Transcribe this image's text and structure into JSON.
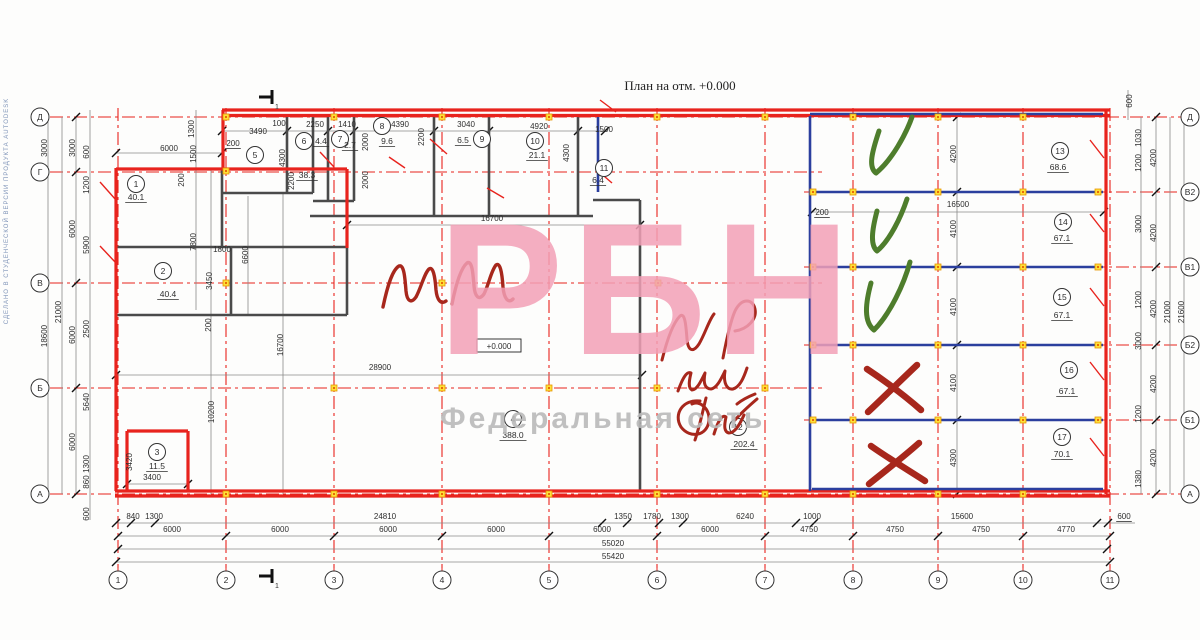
{
  "meta": {
    "title": "План на отм. +0.000",
    "elevation_label": "+0.000",
    "section_mark_label": "1",
    "side_watermark": "СДЕЛАНО В СТУДЕНЧЕСКОЙ ВЕРСИИ ПРОДУКТА AUTODESK"
  },
  "watermark": {
    "big": "РБН",
    "sub": "Федеральная сеть",
    "big_color": "#f2a0b6",
    "sub_color": "#bdbdbd"
  },
  "colors": {
    "wall_red": "#e8231d",
    "wall_blue": "#2b3f9e",
    "wall_grey": "#4a4a4a",
    "grid_red": "#e8231d",
    "dim_line": "#8a8a8a",
    "marker_yellow": "#ffe13a",
    "marker_orange": "#e69500",
    "hand_green": "#4e7d2c",
    "hand_red": "#a7271c"
  },
  "axes": {
    "bottom": [
      {
        "label": "1",
        "x": 118
      },
      {
        "label": "2",
        "x": 226
      },
      {
        "label": "3",
        "x": 334
      },
      {
        "label": "4",
        "x": 442
      },
      {
        "label": "5",
        "x": 549
      },
      {
        "label": "6",
        "x": 657
      },
      {
        "label": "7",
        "x": 765
      },
      {
        "label": "8",
        "x": 853
      },
      {
        "label": "9",
        "x": 938
      },
      {
        "label": "10",
        "x": 1023
      },
      {
        "label": "11",
        "x": 1110
      }
    ],
    "left": [
      {
        "label": "Д",
        "y": 117
      },
      {
        "label": "Г",
        "y": 172
      },
      {
        "label": "В",
        "y": 283
      },
      {
        "label": "Б",
        "y": 388
      },
      {
        "label": "А",
        "y": 494
      }
    ],
    "right": [
      {
        "label": "Д",
        "y": 117
      },
      {
        "label": "В2",
        "y": 192
      },
      {
        "label": "В1",
        "y": 267
      },
      {
        "label": "Б2",
        "y": 345
      },
      {
        "label": "Б1",
        "y": 420
      },
      {
        "label": "А",
        "y": 494
      }
    ]
  },
  "rooms": [
    {
      "n": "1",
      "area": "40.1",
      "cx": 136,
      "cy": 184,
      "ax": 136,
      "ay": 200
    },
    {
      "n": "2",
      "area": "40.4",
      "cx": 163,
      "cy": 271,
      "ax": 168,
      "ay": 297
    },
    {
      "n": "3",
      "area": "11.5",
      "cx": 157,
      "cy": 452,
      "ax": 157,
      "ay": 469
    },
    {
      "n": "4",
      "area": "388.0",
      "cx": 513,
      "cy": 419,
      "ax": 513,
      "ay": 438
    },
    {
      "n": "5",
      "area": "38.3",
      "cx": 255,
      "cy": 155,
      "ax": 307,
      "ay": 178
    },
    {
      "n": "6",
      "area": "4.4",
      "cx": 304,
      "cy": 141,
      "ax": 321,
      "ay": 144
    },
    {
      "n": "7",
      "area": "2.7",
      "cx": 340,
      "cy": 139,
      "ax": 350,
      "ay": 148
    },
    {
      "n": "8",
      "area": "9.6",
      "cx": 382,
      "cy": 126,
      "ax": 387,
      "ay": 144
    },
    {
      "n": "9",
      "area": "6.5",
      "cx": 482,
      "cy": 139,
      "ax": 463,
      "ay": 143
    },
    {
      "n": "10",
      "area": "21.1",
      "cx": 535,
      "cy": 141,
      "ax": 537,
      "ay": 158
    },
    {
      "n": "11",
      "area": "6.4",
      "cx": 604,
      "cy": 168,
      "ax": 598,
      "ay": 183
    },
    {
      "n": "12",
      "area": "202.4",
      "cx": 738,
      "cy": 427,
      "ax": 744,
      "ay": 447
    },
    {
      "n": "13",
      "area": "68.6",
      "cx": 1060,
      "cy": 151,
      "ax": 1058,
      "ay": 170
    },
    {
      "n": "14",
      "area": "67.1",
      "cx": 1063,
      "cy": 222,
      "ax": 1062,
      "ay": 241
    },
    {
      "n": "15",
      "area": "67.1",
      "cx": 1062,
      "cy": 297,
      "ax": 1062,
      "ay": 318
    },
    {
      "n": "16",
      "area": "67.1",
      "cx": 1069,
      "cy": 370,
      "ax": 1067,
      "ay": 394
    },
    {
      "n": "17",
      "area": "70.1",
      "cx": 1062,
      "cy": 437,
      "ax": 1062,
      "ay": 457
    }
  ],
  "dims": [
    {
      "t": "3490",
      "x": 258,
      "y": 134
    },
    {
      "t": "100",
      "x": 279,
      "y": 126
    },
    {
      "t": "2250",
      "x": 315,
      "y": 127
    },
    {
      "t": "1410",
      "x": 347,
      "y": 127
    },
    {
      "t": "4390",
      "x": 400,
      "y": 127
    },
    {
      "t": "3040",
      "x": 466,
      "y": 127
    },
    {
      "t": "4920",
      "x": 539,
      "y": 129
    },
    {
      "t": "1500",
      "x": 604,
      "y": 132
    },
    {
      "t": "200",
      "x": 233,
      "y": 146,
      "f": "u"
    },
    {
      "t": "6000",
      "x": 169,
      "y": 151
    },
    {
      "t": "1300",
      "x": 194,
      "y": 129,
      "f": "r"
    },
    {
      "t": "1500",
      "x": 196,
      "y": 154,
      "f": "r"
    },
    {
      "t": "200",
      "x": 184,
      "y": 180,
      "f": "r"
    },
    {
      "t": "4300",
      "x": 285,
      "y": 158,
      "f": "r"
    },
    {
      "t": "2200",
      "x": 294,
      "y": 181,
      "f": "r"
    },
    {
      "t": "2000",
      "x": 368,
      "y": 142,
      "f": "r"
    },
    {
      "t": "2000",
      "x": 368,
      "y": 180,
      "f": "r"
    },
    {
      "t": "2200",
      "x": 424,
      "y": 137,
      "f": "r"
    },
    {
      "t": "4300",
      "x": 569,
      "y": 153,
      "f": "r"
    },
    {
      "t": "16700",
      "x": 492,
      "y": 221
    },
    {
      "t": "1800",
      "x": 222,
      "y": 252
    },
    {
      "t": "6600",
      "x": 248,
      "y": 255,
      "f": "r"
    },
    {
      "t": "7800",
      "x": 196,
      "y": 242,
      "f": "r"
    },
    {
      "t": "3450",
      "x": 212,
      "y": 281,
      "f": "r"
    },
    {
      "t": "200",
      "x": 211,
      "y": 325,
      "f": "r"
    },
    {
      "t": "16700",
      "x": 283,
      "y": 345,
      "f": "r"
    },
    {
      "t": "28900",
      "x": 380,
      "y": 370
    },
    {
      "t": "10200",
      "x": 214,
      "y": 412,
      "f": "r"
    },
    {
      "t": "3420",
      "x": 132,
      "y": 462,
      "f": "r"
    },
    {
      "t": "3400",
      "x": 152,
      "y": 480
    },
    {
      "t": "16500",
      "x": 958,
      "y": 207
    },
    {
      "t": "200",
      "x": 822,
      "y": 215,
      "f": "u"
    },
    {
      "t": "4200",
      "x": 956,
      "y": 154,
      "f": "r"
    },
    {
      "t": "4100",
      "x": 956,
      "y": 229,
      "f": "r"
    },
    {
      "t": "4100",
      "x": 956,
      "y": 307,
      "f": "r"
    },
    {
      "t": "4100",
      "x": 956,
      "y": 383,
      "f": "r"
    },
    {
      "t": "4300",
      "x": 956,
      "y": 458,
      "f": "r"
    },
    {
      "t": "3000",
      "x": 47,
      "y": 148,
      "f": "r"
    },
    {
      "t": "3000",
      "x": 75,
      "y": 148,
      "f": "r"
    },
    {
      "t": "600",
      "x": 89,
      "y": 152,
      "f": "r"
    },
    {
      "t": "1200",
      "x": 89,
      "y": 185,
      "f": "r"
    },
    {
      "t": "6000",
      "x": 75,
      "y": 229,
      "f": "r"
    },
    {
      "t": "5900",
      "x": 89,
      "y": 245,
      "f": "r"
    },
    {
      "t": "21000",
      "x": 61,
      "y": 312,
      "f": "r"
    },
    {
      "t": "18600",
      "x": 47,
      "y": 336,
      "f": "r"
    },
    {
      "t": "6000",
      "x": 75,
      "y": 335,
      "f": "r"
    },
    {
      "t": "2500",
      "x": 89,
      "y": 329,
      "f": "r"
    },
    {
      "t": "5640",
      "x": 89,
      "y": 402,
      "f": "r"
    },
    {
      "t": "6000",
      "x": 75,
      "y": 442,
      "f": "r"
    },
    {
      "t": "1300",
      "x": 89,
      "y": 464,
      "f": "r"
    },
    {
      "t": "860",
      "x": 89,
      "y": 482,
      "f": "r"
    },
    {
      "t": "600",
      "x": 89,
      "y": 514,
      "f": "r"
    },
    {
      "t": "600",
      "x": 1132,
      "y": 101,
      "f": "r"
    },
    {
      "t": "1030",
      "x": 1141,
      "y": 138,
      "f": "r"
    },
    {
      "t": "1200",
      "x": 1141,
      "y": 163,
      "f": "r"
    },
    {
      "t": "3000",
      "x": 1141,
      "y": 224,
      "f": "r"
    },
    {
      "t": "1200",
      "x": 1141,
      "y": 300,
      "f": "r"
    },
    {
      "t": "3000",
      "x": 1141,
      "y": 341,
      "f": "r"
    },
    {
      "t": "1200",
      "x": 1141,
      "y": 414,
      "f": "r"
    },
    {
      "t": "1380",
      "x": 1141,
      "y": 479,
      "f": "r"
    },
    {
      "t": "4200",
      "x": 1156,
      "y": 158,
      "f": "r"
    },
    {
      "t": "4200",
      "x": 1156,
      "y": 233,
      "f": "r"
    },
    {
      "t": "4200",
      "x": 1156,
      "y": 309,
      "f": "r"
    },
    {
      "t": "4200",
      "x": 1156,
      "y": 384,
      "f": "r"
    },
    {
      "t": "4200",
      "x": 1156,
      "y": 458,
      "f": "r"
    },
    {
      "t": "21000",
      "x": 1170,
      "y": 312,
      "f": "r"
    },
    {
      "t": "21600",
      "x": 1184,
      "y": 312,
      "f": "r"
    },
    {
      "t": "840",
      "x": 133,
      "y": 519
    },
    {
      "t": "1300",
      "x": 154,
      "y": 519
    },
    {
      "t": "24810",
      "x": 385,
      "y": 519
    },
    {
      "t": "1350",
      "x": 623,
      "y": 519
    },
    {
      "t": "1780",
      "x": 652,
      "y": 519
    },
    {
      "t": "1300",
      "x": 680,
      "y": 519
    },
    {
      "t": "6240",
      "x": 745,
      "y": 519
    },
    {
      "t": "1000",
      "x": 812,
      "y": 519
    },
    {
      "t": "15600",
      "x": 962,
      "y": 519
    },
    {
      "t": "600",
      "x": 1124,
      "y": 519,
      "f": "u"
    },
    {
      "t": "6000",
      "x": 172,
      "y": 532
    },
    {
      "t": "6000",
      "x": 280,
      "y": 532
    },
    {
      "t": "6000",
      "x": 388,
      "y": 532
    },
    {
      "t": "6000",
      "x": 496,
      "y": 532
    },
    {
      "t": "6000",
      "x": 602,
      "y": 532
    },
    {
      "t": "6000",
      "x": 710,
      "y": 532
    },
    {
      "t": "4750",
      "x": 809,
      "y": 532
    },
    {
      "t": "4750",
      "x": 895,
      "y": 532
    },
    {
      "t": "4750",
      "x": 981,
      "y": 532
    },
    {
      "t": "4770",
      "x": 1066,
      "y": 532
    },
    {
      "t": "55020",
      "x": 613,
      "y": 546
    },
    {
      "t": "55420",
      "x": 613,
      "y": 559
    }
  ],
  "walls": {
    "red": [
      [
        222,
        110,
        1110,
        110
      ],
      [
        222,
        115.5,
        1110,
        115.5
      ],
      [
        1106,
        110,
        1106,
        494
      ],
      [
        115,
        491,
        1110,
        491
      ],
      [
        115,
        496,
        1110,
        496
      ],
      [
        116,
        168,
        116,
        491
      ],
      [
        116,
        169,
        347,
        169
      ],
      [
        223,
        110,
        223,
        169
      ],
      [
        347,
        169,
        347,
        248
      ],
      [
        127,
        431,
        188,
        431
      ],
      [
        188,
        431,
        188,
        491
      ],
      [
        127,
        431,
        127,
        491
      ]
    ],
    "blue": [
      [
        810,
        114,
        1103,
        114
      ],
      [
        810,
        116,
        810,
        491
      ],
      [
        598,
        117,
        598,
        192
      ],
      [
        812,
        192,
        1103,
        192
      ],
      [
        812,
        267,
        1103,
        267
      ],
      [
        812,
        345,
        1103,
        345
      ],
      [
        812,
        420,
        1103,
        420
      ],
      [
        812,
        489,
        1103,
        489
      ]
    ],
    "grey": [
      [
        222,
        193,
        313,
        193
      ],
      [
        287,
        117,
        287,
        193
      ],
      [
        313,
        117,
        313,
        193
      ],
      [
        328,
        117,
        328,
        201
      ],
      [
        354,
        117,
        354,
        201
      ],
      [
        434,
        117,
        434,
        216
      ],
      [
        489,
        117,
        489,
        216
      ],
      [
        578,
        117,
        578,
        216
      ],
      [
        310,
        216,
        593,
        216
      ],
      [
        313,
        201,
        354,
        201
      ],
      [
        593,
        200,
        640,
        200
      ],
      [
        640,
        200,
        640,
        491
      ],
      [
        116,
        247,
        347,
        247
      ],
      [
        222,
        169,
        222,
        247
      ],
      [
        231,
        247,
        231,
        315
      ],
      [
        116,
        315,
        347,
        315
      ],
      [
        347,
        248,
        347,
        315
      ]
    ],
    "thin": [
      [
        222,
        131,
        607,
        131
      ],
      [
        116,
        153,
        222,
        153
      ],
      [
        347,
        225,
        640,
        225
      ],
      [
        812,
        212,
        1104,
        212
      ],
      [
        116,
        375,
        642,
        375
      ],
      [
        116,
        523,
        1135,
        523
      ],
      [
        118,
        536,
        1110,
        536
      ],
      [
        118,
        549,
        1107,
        549
      ],
      [
        116,
        562,
        1110,
        562
      ],
      [
        48,
        117,
        48,
        494
      ],
      [
        62,
        117,
        62,
        494
      ],
      [
        76,
        117,
        76,
        494
      ],
      [
        90,
        110,
        90,
        520
      ],
      [
        1128,
        90,
        1128,
        120
      ],
      [
        1141,
        117,
        1141,
        494
      ],
      [
        1156,
        117,
        1156,
        494
      ],
      [
        1170,
        117,
        1170,
        494
      ],
      [
        1184,
        110,
        1184,
        500
      ],
      [
        957,
        117,
        957,
        494
      ],
      [
        196,
        110,
        196,
        310
      ],
      [
        211,
        169,
        211,
        494
      ],
      [
        248,
        196,
        248,
        315
      ],
      [
        283,
        192,
        283,
        494
      ],
      [
        127,
        484,
        188,
        484
      ]
    ]
  },
  "ticks": {
    "y536": [
      118,
      226,
      334,
      442,
      549,
      657,
      765,
      853,
      938,
      1023,
      1110
    ],
    "y523": [
      116,
      131,
      155,
      602,
      627,
      659,
      683,
      796,
      814,
      1097,
      1108
    ],
    "y549": [
      118,
      1107
    ],
    "y562": [
      116,
      1110
    ],
    "x76": [
      117,
      172,
      283,
      388,
      494
    ],
    "x957": [
      117,
      192,
      267,
      345,
      420,
      494
    ],
    "x1156": [
      117,
      192,
      267,
      345,
      420,
      494
    ],
    "y131": [
      222,
      287,
      328,
      354,
      434,
      489,
      578,
      605
    ],
    "y153": [
      116,
      222
    ],
    "y225": [
      347,
      640
    ],
    "y212": [
      812,
      1104
    ],
    "y375": [
      116,
      642
    ],
    "y484": [
      127,
      188
    ]
  },
  "markers": {
    "rows": [
      {
        "y": 117,
        "xs": [
          226,
          334,
          442,
          549,
          657,
          765,
          853,
          938,
          1023
        ]
      },
      {
        "y": 171,
        "xs": [
          226
        ]
      },
      {
        "y": 283,
        "xs": [
          226,
          442,
          658
        ]
      },
      {
        "y": 388,
        "xs": [
          334,
          442,
          549,
          657,
          765
        ]
      },
      {
        "y": 494,
        "xs": [
          226,
          334,
          442,
          549,
          657,
          765,
          853,
          938,
          1023
        ]
      },
      {
        "y": 192,
        "xs": [
          813,
          853,
          938,
          1023,
          1098
        ]
      },
      {
        "y": 267,
        "xs": [
          813,
          853,
          938,
          1023,
          1098
        ]
      },
      {
        "y": 345,
        "xs": [
          813,
          853,
          938,
          1023,
          1098
        ]
      },
      {
        "y": 420,
        "xs": [
          813,
          853,
          938,
          1023,
          1098
        ]
      }
    ]
  },
  "door_swings": [
    [
      100,
      182,
      116,
      200
    ],
    [
      100,
      246,
      116,
      263
    ],
    [
      320,
      152,
      334,
      167
    ],
    [
      389,
      157,
      405,
      168
    ],
    [
      430,
      139,
      447,
      154
    ],
    [
      487,
      188,
      504,
      198
    ],
    [
      600,
      100,
      616,
      112
    ],
    [
      597,
      170,
      612,
      183
    ],
    [
      1090,
      140,
      1104,
      158
    ],
    [
      1090,
      214,
      1104,
      232
    ],
    [
      1090,
      288,
      1104,
      306
    ],
    [
      1090,
      362,
      1104,
      380
    ],
    [
      1090,
      438,
      1104,
      456
    ]
  ],
  "handwriting": {
    "green_checks": [
      "M 879,131 C 872,152 868,167 876,173 C 892,160 906,134 912,117",
      "M 877,211 C 872,230 870,245 877,251 C 890,240 901,217 907,199",
      "M 871,283 C 865,305 864,322 874,330 C 890,314 904,284 910,262"
    ],
    "red_crosses": [
      "M 867,369 C 885,381 905,396 921,410 M 917,365 C 900,381 883,398 868,412",
      "M 871,446 C 888,458 908,470 925,481 M 919,443 C 901,459 885,471 869,484"
    ],
    "mm": [
      "M 383,307 C 387,288 392,270 399,266 C 404,264 405,278 406,291 C 407,301 411,304 416,297 C 421,288 424,274 429,269 C 433,266 435,276 436,290 C 437,300 441,305 446,301",
      "M 452,304 C 456,284 461,268 467,263 C 472,260 473,273 474,286 C 475,297 479,301 484,294 C 489,284 491,271 496,265 C 500,262 502,272 503,287 C 504,298 508,304 513,299"
    ],
    "mr": [
      "M 662,360 C 667,340 673,323 680,316 C 685,312 686,326 687,339 C 688,351 693,353 699,344 C 705,334 709,320 714,314",
      "M 723,358 C 727,337 731,320 735,311 C 742,297 753,299 755,309 C 757,319 748,329 735,331",
      "M 678,391 C 683,377 687,371 691,373 C 689,381 688,388 692,390 C 697,390 701,381 705,373 C 703,383 705,389 711,389 C 717,388 721,379 725,371 C 723,383 727,390 733,389 C 740,387 744,377 747,368",
      "M 700,401 C 683,399 673,414 681,427 C 690,439 707,436 709,421 C 710,408 699,400 692,404 M 695,440 C 700,425 703,410 706,398",
      "M 714,434 C 718,421 722,414 726,417 C 724,426 724,432 729,433 C 735,433 740,424 744,415 M 737,404 C 743,399 750,396 755,394 M 735,420 C 742,412 750,405 757,399"
    ]
  },
  "section_marks": [
    {
      "x": 268,
      "y": 97,
      "dir": "top"
    },
    {
      "x": 268,
      "y": 576,
      "dir": "bottom"
    }
  ],
  "elev_box": {
    "x": 477,
    "y": 339,
    "w": 44,
    "h": 13,
    "tx": 499,
    "ty": 349
  }
}
